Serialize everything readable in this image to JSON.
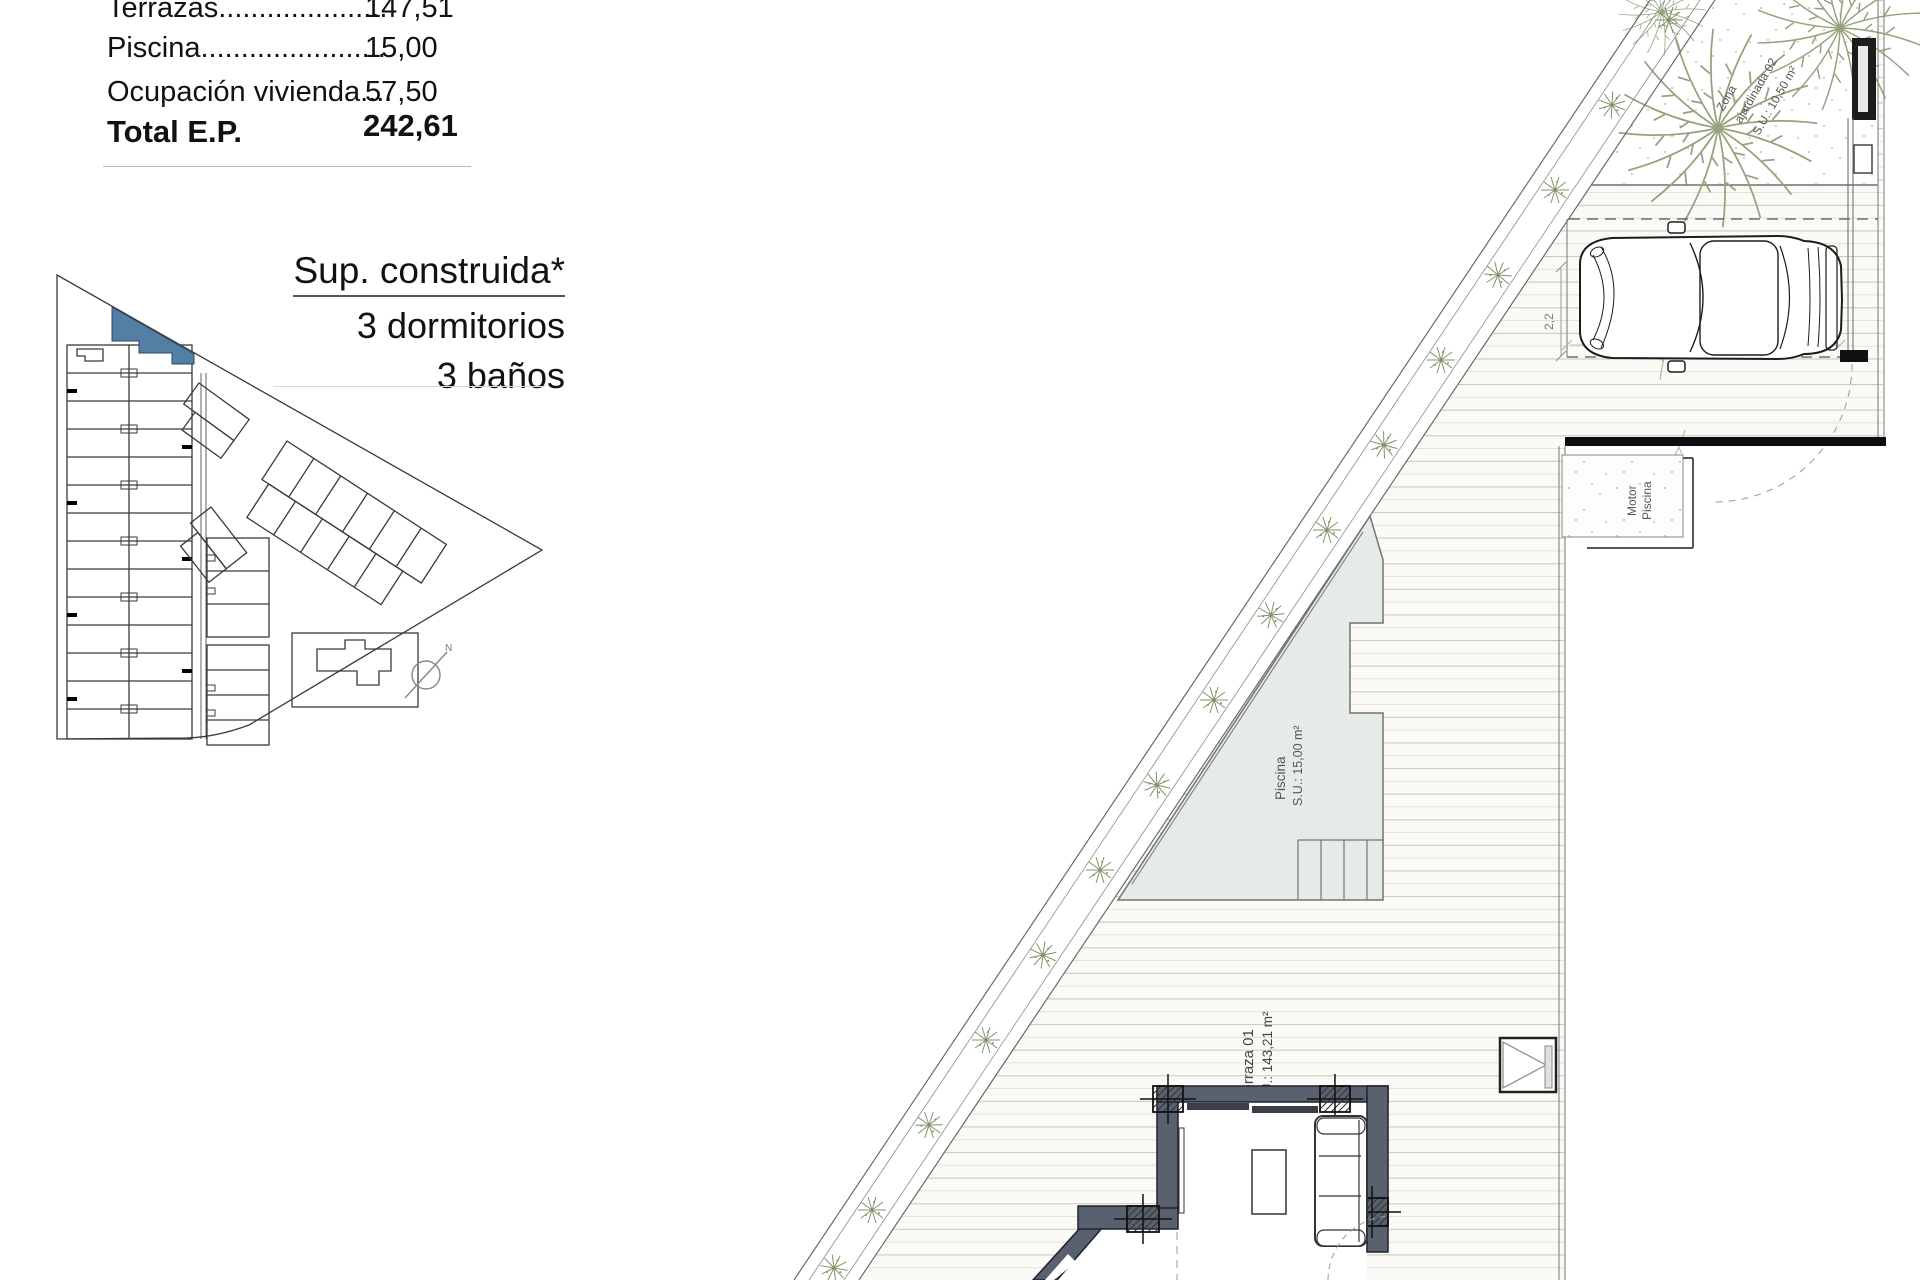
{
  "summary_table": {
    "rows": [
      {
        "label": "Terrazas.....................",
        "value": "147,51"
      },
      {
        "label": "Piscina.......................",
        "value": "15,00"
      },
      {
        "label": "Ocupación vivienda....",
        "value": "57,50"
      }
    ],
    "total": {
      "label": "Total E.P.",
      "value": "242,61"
    }
  },
  "spec_block": {
    "title": "Sup. construida*",
    "line1": "3 dormitorios",
    "line2": "3 baños"
  },
  "site_plan": {
    "north_label": "N",
    "highlight_color": "#537fa5"
  },
  "main_plan": {
    "labels": {
      "zona_line1": "Zona",
      "zona_line2": "ajardinada 02",
      "zona_line3": "S.U.: 10,50 m²",
      "piscina_line1": "Piscina",
      "piscina_line2": "S.U.: 15,00 m²",
      "terraza_line1": "Terraza 01",
      "terraza_line2": "S.U.: 143,21 m²",
      "motor_line1": "Motor",
      "motor_line2": "Piscina",
      "dim_width": "2,2",
      "dim_length": "5"
    },
    "colors": {
      "pool_fill": "#e7ebe7",
      "wall_fill": "#59616e",
      "vegetation": "#7d9468",
      "deck_line": "#cdc9bf"
    }
  }
}
